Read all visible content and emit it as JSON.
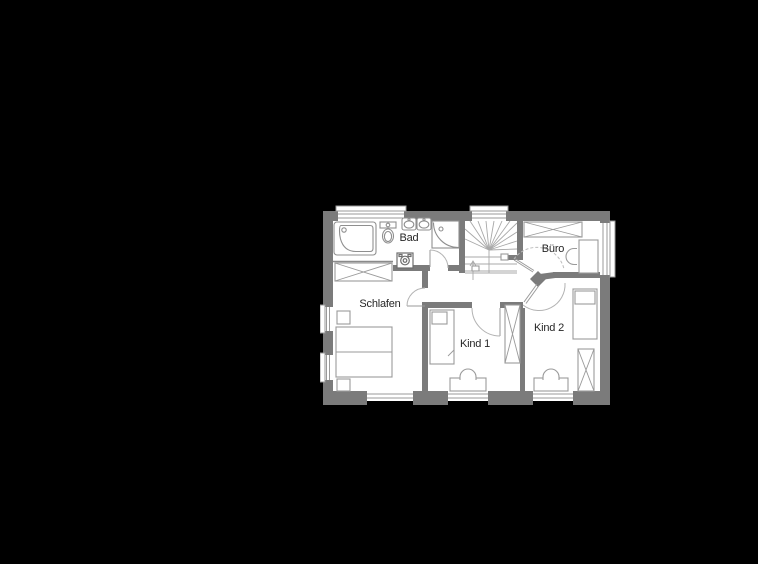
{
  "canvas": {
    "width": 758,
    "height": 564,
    "background": "#000000"
  },
  "floor_plan": {
    "kind": "architectural-floor-plan",
    "position": {
      "left": 320,
      "top": 203,
      "width": 296,
      "height": 212
    },
    "colors": {
      "wall": "#7b7b7b",
      "floor": "#ffffff",
      "fixture_line": "#8f8f8f",
      "furniture_line": "#9a9a9a",
      "door_swing_line": "#b3b3b3",
      "label_text": "#262626",
      "background": "#000000"
    },
    "rooms": [
      {
        "id": "bad",
        "label": "Bad"
      },
      {
        "id": "buero",
        "label": "Büro"
      },
      {
        "id": "schlafen",
        "label": "Schlafen"
      },
      {
        "id": "kind1",
        "label": "Kind 1"
      },
      {
        "id": "kind2",
        "label": "Kind 2"
      }
    ],
    "symbols": [
      "staircase-winder",
      "corner-bathtub",
      "toilet",
      "double-washbasin",
      "corner-shower",
      "washing-machine",
      "wardrobe",
      "double-bed",
      "nightstand",
      "single-bed",
      "desk",
      "chair",
      "door-swing",
      "window"
    ]
  }
}
